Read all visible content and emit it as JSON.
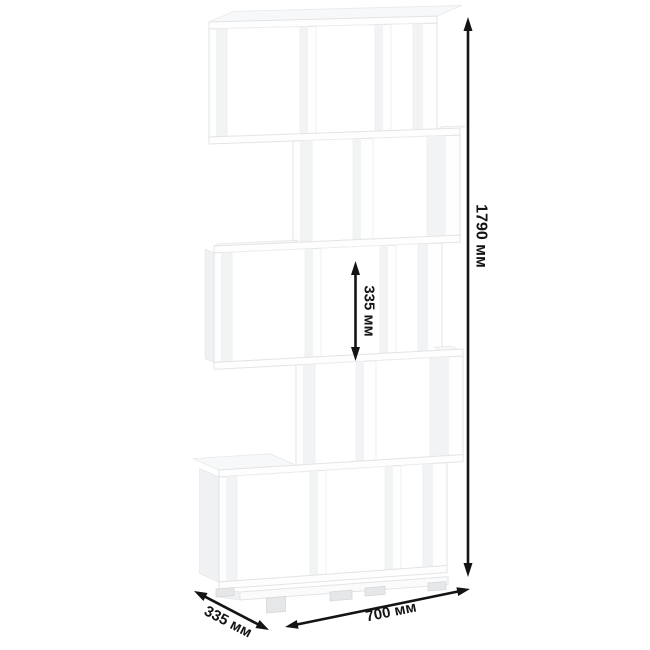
{
  "diagram": {
    "kind": "furniture dimension drawing",
    "unit_tiers": 5,
    "dimensions": {
      "height": "1790 мм",
      "shelf_spacing": "335 мм",
      "depth": "335 мм",
      "width": "700 мм"
    },
    "colors": {
      "background": "#ffffff",
      "furniture_edge": "#e2e4e6",
      "furniture_shade": "#f2f3f5",
      "annotation": "#141414"
    }
  }
}
